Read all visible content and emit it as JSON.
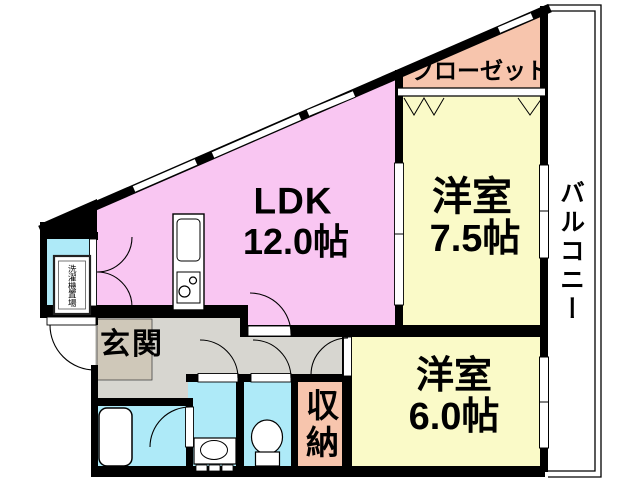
{
  "floor_plan": {
    "rooms": {
      "ldk": {
        "label": "LDK",
        "size": "12.0帖"
      },
      "western_room_upper": {
        "label": "洋室",
        "size": "7.5帖"
      },
      "western_room_lower": {
        "label": "洋室",
        "size": "6.0帖"
      },
      "closet": {
        "label": "クローゼット"
      },
      "balcony": {
        "label": "バルコニー"
      },
      "entrance": {
        "label": "玄関"
      },
      "storage": {
        "label": "収納"
      },
      "laundry_space": {
        "label": "洗濯機置場"
      }
    },
    "colors": {
      "background": "#ffffff",
      "ldk": "#f9c6f2",
      "western_room": "#fafac8",
      "closet": "#f7c5ad",
      "storage": "#f7c5ad",
      "wet_area": "#aeeaf8",
      "hallway": "#d7d6d0",
      "entrance_step": "#cfc8b9",
      "wall": "#000000",
      "fixture": "#ffffff"
    }
  }
}
